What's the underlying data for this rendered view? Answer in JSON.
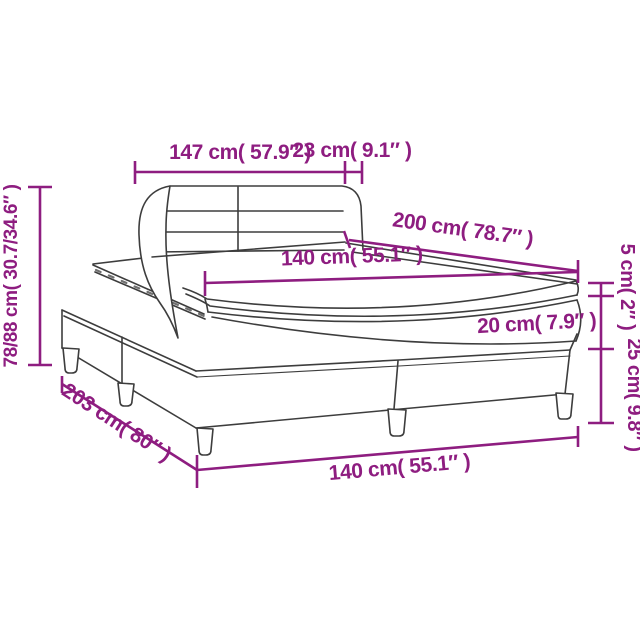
{
  "diagram": {
    "type": "product-dimension-diagram",
    "subject": "box spring bed with headboard, mattress and topper",
    "colors": {
      "dimension_accent": "#8e1d80",
      "outline": "#3d3d3d",
      "background": "#ffffff"
    },
    "dimensions": {
      "headboard_width": "147 cm( 57.9″ )",
      "headboard_side_depth": "23 cm( 9.1″ )",
      "height_range": "78/88 cm( 30.7/34.6″ )",
      "mattress_length": "200 cm( 78.7″ )",
      "mattress_width": "140 cm( 55.1″ )",
      "topper_height": "5 cm( 2″ )",
      "mattress_height": "20 cm( 7.9″ )",
      "base_height": "25 cm( 9.8″ )",
      "bed_length": "203 cm( 80″ )",
      "bed_width": "140 cm( 55.1″ )"
    }
  }
}
